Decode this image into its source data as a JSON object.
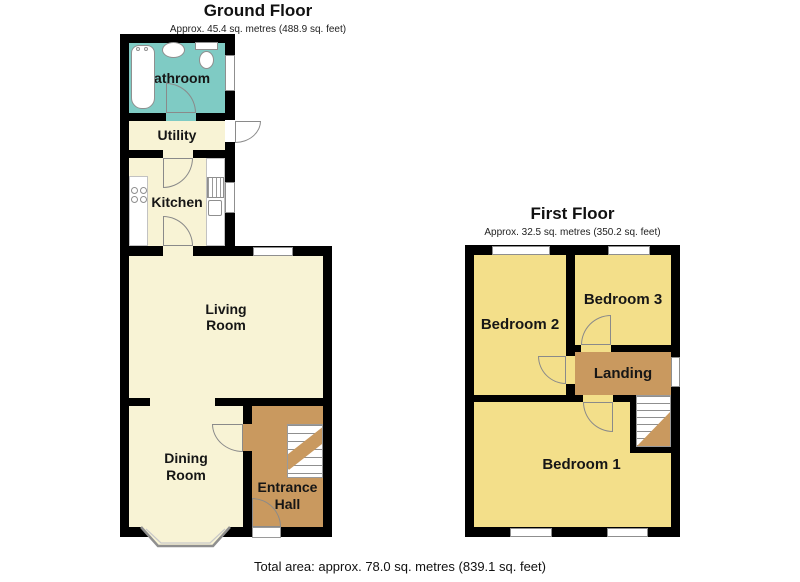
{
  "ground_floor": {
    "title": "Ground Floor",
    "subtitle": "Approx. 45.4 sq. metres (488.9 sq. feet)",
    "rooms": {
      "bathroom": "Bathroom",
      "utility": "Utility",
      "kitchen": "Kitchen",
      "living_room": "Living\nRoom",
      "dining_room": "Dining\nRoom",
      "entrance_hall": "Entrance\nHall"
    }
  },
  "first_floor": {
    "title": "First Floor",
    "subtitle": "Approx. 32.5 sq. metres (350.2 sq. feet)",
    "rooms": {
      "bedroom2": "Bedroom 2",
      "bedroom3": "Bedroom 3",
      "landing": "Landing",
      "bedroom1": "Bedroom 1"
    }
  },
  "footer": {
    "total_area": "Total area: approx. 78.0 sq. metres (839.1 sq. feet)"
  },
  "colors": {
    "wall": "#000000",
    "ground_room_fill": "#f8f3d5",
    "bathroom_fill": "#7fcbc4",
    "hall_landing_fill": "#c9995f",
    "bedroom_fill": "#f3df8a",
    "fixture_stroke": "#8f8f8f"
  }
}
